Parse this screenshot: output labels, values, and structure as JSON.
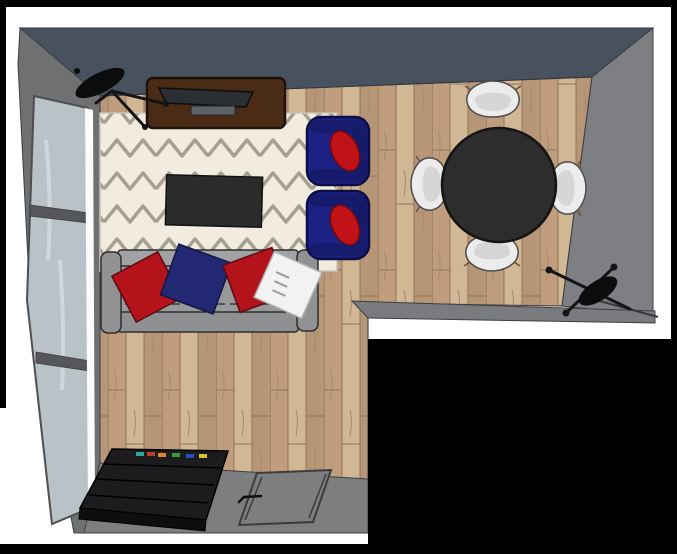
{
  "scene": {
    "title": "Top-down 3D interior render",
    "room_shape": "L-shaped living room with dining corner, viewed from above",
    "colors": {
      "frame": "#000000",
      "background": "#ffffff",
      "wall_top": "#47525e",
      "wall_side": "#7d7f82",
      "wall_interior": "#797b7e",
      "wall_bottom": "#7c7e80",
      "window_frame": "#595b5d",
      "window_glass": "#b9c2c6",
      "window_trim": "#fbfbfb",
      "floor_base": "#c8ab8a",
      "rug": "#f1ecdf",
      "rug_pattern": "#a59f91",
      "console": "#4a2b15",
      "tv": "#2b2e33",
      "soundbar": "#5c6166",
      "coffee_table": "#2b2b2b",
      "sofa_body": "#98999b",
      "sofa_back": "#a0a2a3",
      "sofa_front": "#8e9092",
      "sofa_arm": "#909294",
      "pillow_red": "#b5131c",
      "pillow_navy": "#232875",
      "pillow_white": "#f2f2f2",
      "armchair": "#1c2183",
      "armchair_trim": "#161b6e",
      "armchair_cushion": "#c11218",
      "dining_table": "#2d2d2d",
      "dining_chair": "#ececec",
      "dining_chair_shade": "#cfcfcf",
      "lamp": "#0c0c0c",
      "bookcase_top": "#1c1c1e",
      "bookcase_front": "#0e0e0e",
      "door": "#7c7e80",
      "cutout": "#000000",
      "book_colors": [
        "#2ba8a0",
        "#c43a2a",
        "#e0862a",
        "#3a9a3a",
        "#2a4ac4",
        "#d4c42a"
      ]
    },
    "furniture": [
      {
        "name": "window-wall",
        "description": "left wall with tall three-pane window"
      },
      {
        "name": "tv-console",
        "description": "dark walnut media console with flat TV and soundbar"
      },
      {
        "name": "floor-lamp-left",
        "description": "black tripod floor lamp, top-left corner"
      },
      {
        "name": "area-rug",
        "description": "cream rug with grey chevron zigzag pattern"
      },
      {
        "name": "coffee-table",
        "description": "dark charcoal rectangular coffee table"
      },
      {
        "name": "sofa",
        "description": "grey three-seat sofa with red, navy and white throw pillows"
      },
      {
        "name": "armchair-1",
        "description": "navy armchair with red cushion"
      },
      {
        "name": "armchair-2",
        "description": "navy armchair with red cushion"
      },
      {
        "name": "dining-table",
        "description": "round black dining table"
      },
      {
        "name": "dining-chairs",
        "description": "four white shell chairs around table"
      },
      {
        "name": "floor-lamp-right",
        "description": "black tripod floor lamp against right wall"
      },
      {
        "name": "bookcase",
        "description": "black low storage unit with colored books, bottom-left"
      },
      {
        "name": "door",
        "description": "grey door panel in bottom wall"
      },
      {
        "name": "cutout",
        "description": "black void outside the L-shaped room, bottom-right"
      }
    ]
  }
}
